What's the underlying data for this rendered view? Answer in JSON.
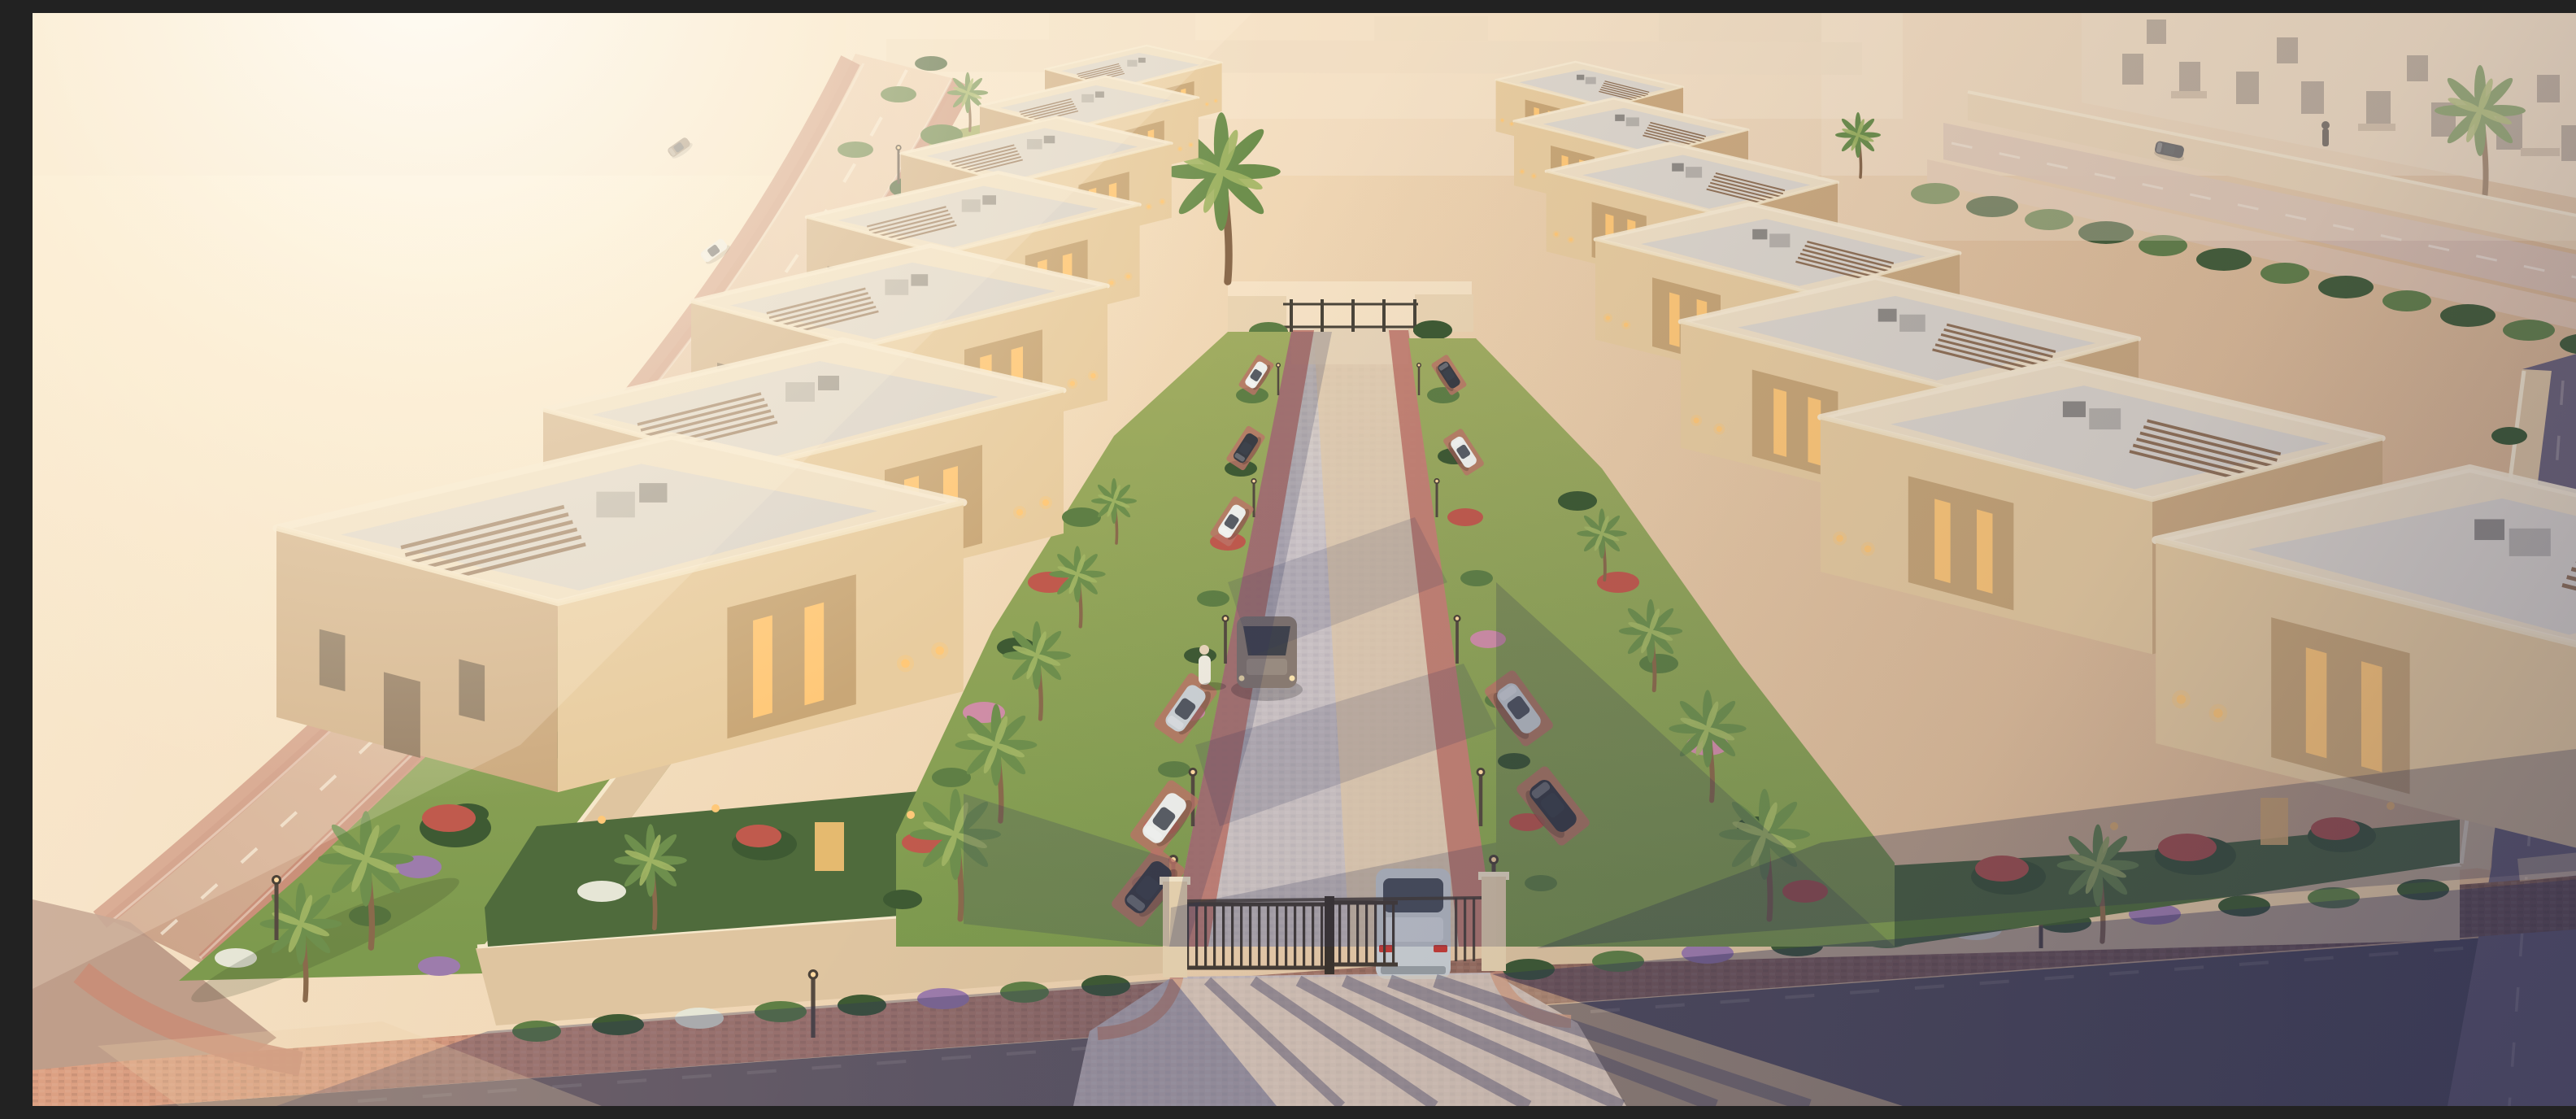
{
  "scene": {
    "description": "Aerial golden-hour 3D rendering of a gated desert villa compound: two rows of flat-roofed sand-coloured villas flank a central paved street that runs from a dark metal entrance gate at the bottom to a rear fence gate at the top, with landscaped gardens, palm trees, parked cars, perimeter roads and distant apartment blocks",
    "view": "high-angle aerial looking down the central street toward the rear gate",
    "lighting": {
      "time": "golden hour",
      "sun_position": "upper left",
      "effects": [
        "strong sun glare top-left",
        "long shadows cast to the lower right",
        "warm haze over desert"
      ]
    },
    "environment": {
      "terrain": "empty desert sand lots around the compound",
      "perimeter_roads": [
        "curved asphalt road with white dashes on the left",
        "road in front of apartment blocks at top right",
        "road along the right edge",
        "shaded road across the bottom edge"
      ],
      "distant_buildings": "cream two-storey apartment blocks with windows and balconies, top right"
    },
    "compound": {
      "villa_rows": [
        {
          "side": "left",
          "count": 7
        },
        {
          "side": "right",
          "count": 7
        }
      ],
      "villa_style": "flat-roofed beige villas with parapets, grey roof terraces, rooftop AC units, brown pergola louvres, warm-lit narrow windows and wall sconces",
      "perimeter": "beige boundary wall ringed by flowering hedge and red-brick sidewalk",
      "central_street": {
        "surface": "grey stone pavers, sunlit on the right, shadowed on the left",
        "parking": "angled bays on red paver strips along both sides",
        "lamps": "rows of street lamps on both sides"
      },
      "gates": {
        "main": "dark metal double gate with beige pillars at bottom centre, one side open",
        "rear": "low metal fence gate at the far end of the street"
      }
    },
    "vehicles": [
      {
        "type": "sedan",
        "color": "silver",
        "location": "exiting through the main gate"
      },
      {
        "type": "sedan",
        "color": "bronze-grey",
        "location": "driving up the central street"
      },
      {
        "type": "sedan",
        "color": "silver",
        "location": "parked left of street, middle"
      },
      {
        "type": "sedan",
        "color": "white",
        "location": "parked left of street, lower"
      },
      {
        "type": "sedan",
        "color": "dark grey",
        "location": "parked left of street, near gate"
      },
      {
        "type": "coupe",
        "color": "white",
        "location": "parked left of street, upper"
      },
      {
        "type": "sedan",
        "color": "dark grey",
        "location": "parked left of street, upper"
      },
      {
        "type": "sedan",
        "color": "white",
        "location": "parked left of street, top"
      },
      {
        "type": "suv",
        "color": "silver",
        "location": "parked right of street, middle"
      },
      {
        "type": "sedan",
        "color": "dark grey",
        "location": "parked right of street, lower"
      },
      {
        "type": "suv",
        "color": "white",
        "location": "parked right of street, upper"
      },
      {
        "type": "sedan",
        "color": "dark grey",
        "location": "parked right of street, top"
      },
      {
        "type": "sedan",
        "color": "bronze",
        "location": "left perimeter road, upper"
      },
      {
        "type": "sedan",
        "color": "white",
        "location": "left perimeter road, upper"
      },
      {
        "type": "sedan",
        "color": "dark bronze",
        "location": "driving on the left perimeter road"
      },
      {
        "type": "sedan",
        "color": "dark grey",
        "location": "road by the top-right apartments"
      },
      {
        "type": "sedan",
        "color": "dark grey",
        "location": "right-edge road"
      }
    ],
    "people": [
      {
        "description": "figure in white robe",
        "location": "left edge of the central street"
      },
      {
        "description": "pedestrian",
        "location": "sidewalk by the top-right apartments"
      }
    ],
    "vegetation": {
      "palm_trees": "date palms along the left road, garden strips and compound corners",
      "lawns": "green lawn strips beside the street and around the south-west corner",
      "shrubs": [
        "green hedges",
        "red flowering poinciana trees",
        "pink bougainvillea",
        "purple and white flower beds"
      ]
    },
    "street_furniture": [
      "street lamps along roads and central street",
      "warm wall sconces on villa facades"
    ]
  },
  "palette": {
    "sun_glow": "#fff7e6",
    "sand_light": "#f6e3c6",
    "sand_mid": "#ecd2ae",
    "sand_deep": "#d9b68f",
    "road_left": "#dcb79a",
    "road_dark": "#565264",
    "walk_brick": "#c98d77",
    "walk_brick_dark": "#7c5b53",
    "pave_cool": "#c7bfc5",
    "pave_warm": "#e3cbaa",
    "park_strip": "#bd7468",
    "wall_beige": "#dfc5a0",
    "wall_top": "#f6e8cb",
    "villa_roof": "#f0e0c5",
    "roof_terrace": "#d9d3cd",
    "villa_front": "#e8cc9f",
    "villa_side": "#cdab80",
    "window_glow": "#ffc878",
    "window_dark": "#6e5a44",
    "ac_gray": "#b8b2aa",
    "pergola": "#8a684a",
    "lawn": "#84a050",
    "lawn_dark": "#4f6b3c",
    "bush": "#5f7f45",
    "bush_dark": "#3e5a33",
    "flower_red": "#c05a4d",
    "flower_pink": "#cf8da6",
    "flower_purple": "#9d7cac",
    "flower_white": "#e6e6d6",
    "palm": "#6e8f4d",
    "palm_light": "#a3b665",
    "trunk": "#8a6a4c",
    "gate_metal": "#453c33",
    "lamp_pole": "#554a40",
    "car_silver": "#ccd1d4",
    "car_white": "#eff0ec",
    "car_dark": "#3a3d44",
    "car_bronze": "#8b7866",
    "car_brown": "#6b5a4c",
    "shadow": "#32355c",
    "light_warm": "#f2d3a6"
  }
}
